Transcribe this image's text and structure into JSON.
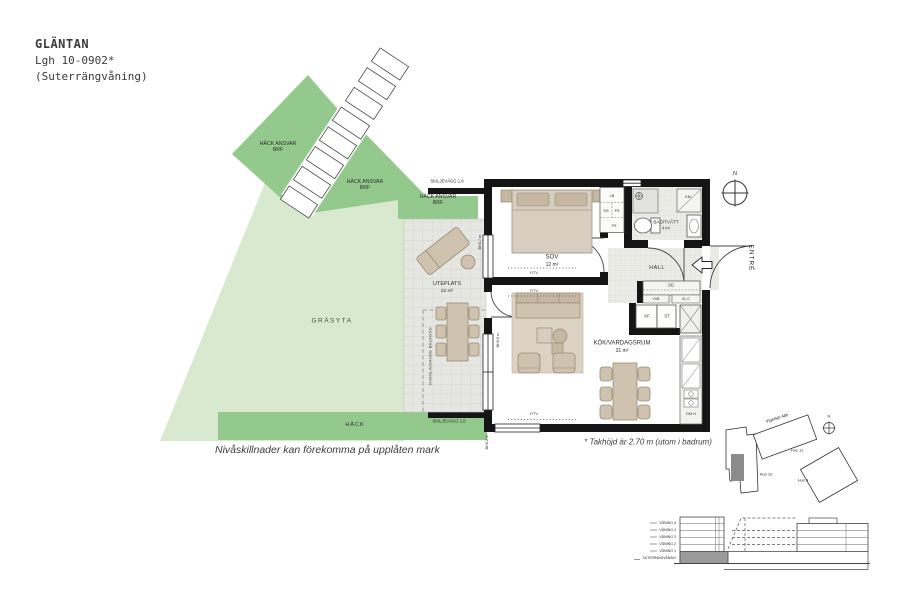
{
  "title": {
    "project": "GLÄNTAN",
    "unit": "Lgh 10-0902*",
    "floor": "(Suterrängvåning)"
  },
  "colors": {
    "grass": "#d8e9cf",
    "hedge": "#93c98c",
    "patio": "#e6e6e2",
    "wall": "#151515",
    "furniture": "#cfc2ae",
    "apartment_highlight": "#8c8c8c"
  },
  "garden": {
    "hedge1": "HÄCK ANSVAR BRF",
    "hedge2": "HÄCK ANSVAR BRF",
    "hedge3": "HÄCK ANSVAR BRF",
    "grass": "GRÄSYTA",
    "hedge_bottom": "HÄCK",
    "partition_top": "SKILJEVÄGG 1.8",
    "partition_bottom": "SKILJEVÄGG 1,8",
    "note": "Nivåskillnader kan förekomma på upplåten mark"
  },
  "plan": {
    "rooms": {
      "sov": {
        "name": "SOV",
        "area": "12 m²"
      },
      "bad": {
        "name": "BAD/TVÄTT",
        "area": "4 m²"
      },
      "hall": {
        "name": "HALL"
      },
      "kok": {
        "name": "KÖK/VARDAGSRUM",
        "area": "31 m²"
      },
      "uteplats": {
        "name": "UTEPLATS",
        "area": "22 m²"
      }
    },
    "fixtures": {
      "lb": "LB",
      "sg_bedroom": "SG",
      "fs": "FS",
      "km": "KM",
      "sg_hall": "SG",
      "vvb": "VVB",
      "elc": "EL.C",
      "kf": "KF",
      "st": "ST",
      "dm": "DM H",
      "ftv": "F/TV"
    },
    "balcony_above": "OVANLIGGANDE BALKONG",
    "levels": {
      "window_top": "BH0,7 m",
      "window_mid": "BH0,6 m",
      "window_bottom": "BH0,2 m"
    },
    "entry": "ENTRÉ",
    "north": "N",
    "ceiling_note": "* Takhöjd är 2,70 m (utom i badrum)"
  },
  "sitemap": {
    "street": "Vigelsjö Allé",
    "hus10": "Hus 10",
    "hus11": "Hus 11",
    "hus9": "Hus 9",
    "north": "N"
  },
  "section": {
    "floors": [
      "VÅNING 5",
      "VÅNING 4",
      "VÅNING 3",
      "VÅNING 2",
      "VÅNING 1"
    ],
    "basement": "SUTERRÄNGVÅNING"
  }
}
